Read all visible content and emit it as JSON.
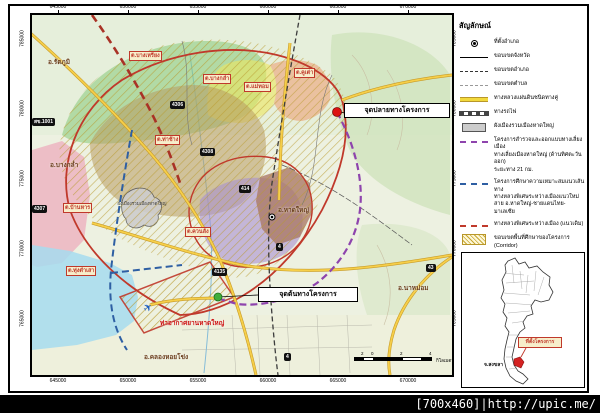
{
  "watermark": "[700x460]|http://upic.me/",
  "map": {
    "axis": {
      "top": [
        "645000",
        "650000",
        "655000",
        "660000",
        "665000",
        "670000"
      ],
      "bottom": [
        "645000",
        "650000",
        "655000",
        "660000",
        "665000",
        "670000"
      ],
      "left": [
        "785000",
        "780000",
        "775000",
        "770000",
        "765000"
      ],
      "right": [
        "785000",
        "780000",
        "775000",
        "770000",
        "765000"
      ]
    },
    "callouts": {
      "end_point": "จุดปลายทางโครงการ",
      "start_point": "จุดต้นทางโครงการ"
    },
    "airport_label": "ท่าอากาศยานหาดใหญ่",
    "city_plan_label": "ผังเมืองรวมเมืองหาดใหญ่",
    "district_labels": [
      {
        "text": "อ.รัตภูมิ"
      },
      {
        "text": "อ.บางกล่ำ"
      },
      {
        "text": "อ.หาดใหญ่"
      },
      {
        "text": "อ.นาหม่อม"
      },
      {
        "text": "อ.คลองหอยโข่ง"
      }
    ],
    "subdistrict_labels": [
      {
        "text": "ต.บางเหรียง"
      },
      {
        "text": "ต.บางกล่ำ"
      },
      {
        "text": "ต.แม่ทอม"
      },
      {
        "text": "ต.คูเต่า"
      },
      {
        "text": "ต.ท่าช้าง"
      },
      {
        "text": "ต.บ้านหาร"
      },
      {
        "text": "ต.ควนลัง"
      },
      {
        "text": "ต.ทุ่งตำเสา"
      }
    ],
    "road_shields": [
      {
        "text": "สข.1001"
      },
      {
        "text": "4306"
      },
      {
        "text": "4307"
      },
      {
        "text": "4308"
      },
      {
        "text": "414"
      },
      {
        "text": "4"
      },
      {
        "text": "4135"
      },
      {
        "text": "43"
      },
      {
        "text": "4"
      }
    ],
    "scalebar": {
      "labels": [
        "2",
        "0",
        "2",
        "4"
      ],
      "unit": "กิโลเมตร"
    }
  },
  "legend": {
    "title": "สัญลักษณ์",
    "items": [
      {
        "label": "ที่ตั้งอำเภอ"
      },
      {
        "label": "ขอบเขตจังหวัด"
      },
      {
        "label": "ขอบเขตอำเภอ"
      },
      {
        "label": "ขอบเขตตำบล"
      },
      {
        "label": "ทางหลวงแผ่นดินชนิดทางคู่"
      },
      {
        "label": "ทางรถไฟ"
      },
      {
        "label": "ผังเมืองรวมเมืองหาดใหญ่"
      },
      {
        "label": "โครงการสำรวจและออกแบบทางเลี่ยงเมือง\nทางเลี่ยงเมืองหาดใหญ่ (ด้านทิศตะวันออก)\nระยะทาง 21 กม."
      },
      {
        "label": "โครงการศึกษาความเหมาะสมแนวเส้นทาง\nทางหลวงพิเศษระหว่างเมืองแนวใหม่\nสาย อ.หาดใหญ่-ชายแดนไทย-มาเลเซีย"
      },
      {
        "label": "ทางหลวงพิเศษระหว่างเมือง (แนวเดิม)"
      },
      {
        "label": "ขอบเขตพื้นที่ศึกษาของโครงการ\n(Corridor)"
      }
    ]
  },
  "inset": {
    "callout": "ที่ตั้งโครงการ",
    "province_label": "จ.สงขลา"
  },
  "colors": {
    "corridor_red": "#c0392b",
    "project_purple": "#8e44ad",
    "study_blue": "#2e5fa3",
    "highway_yellow": "#f0c33c",
    "hatch": "#c8a832",
    "end_dot": "#dd1111",
    "start_dot": "#3fae3a"
  }
}
